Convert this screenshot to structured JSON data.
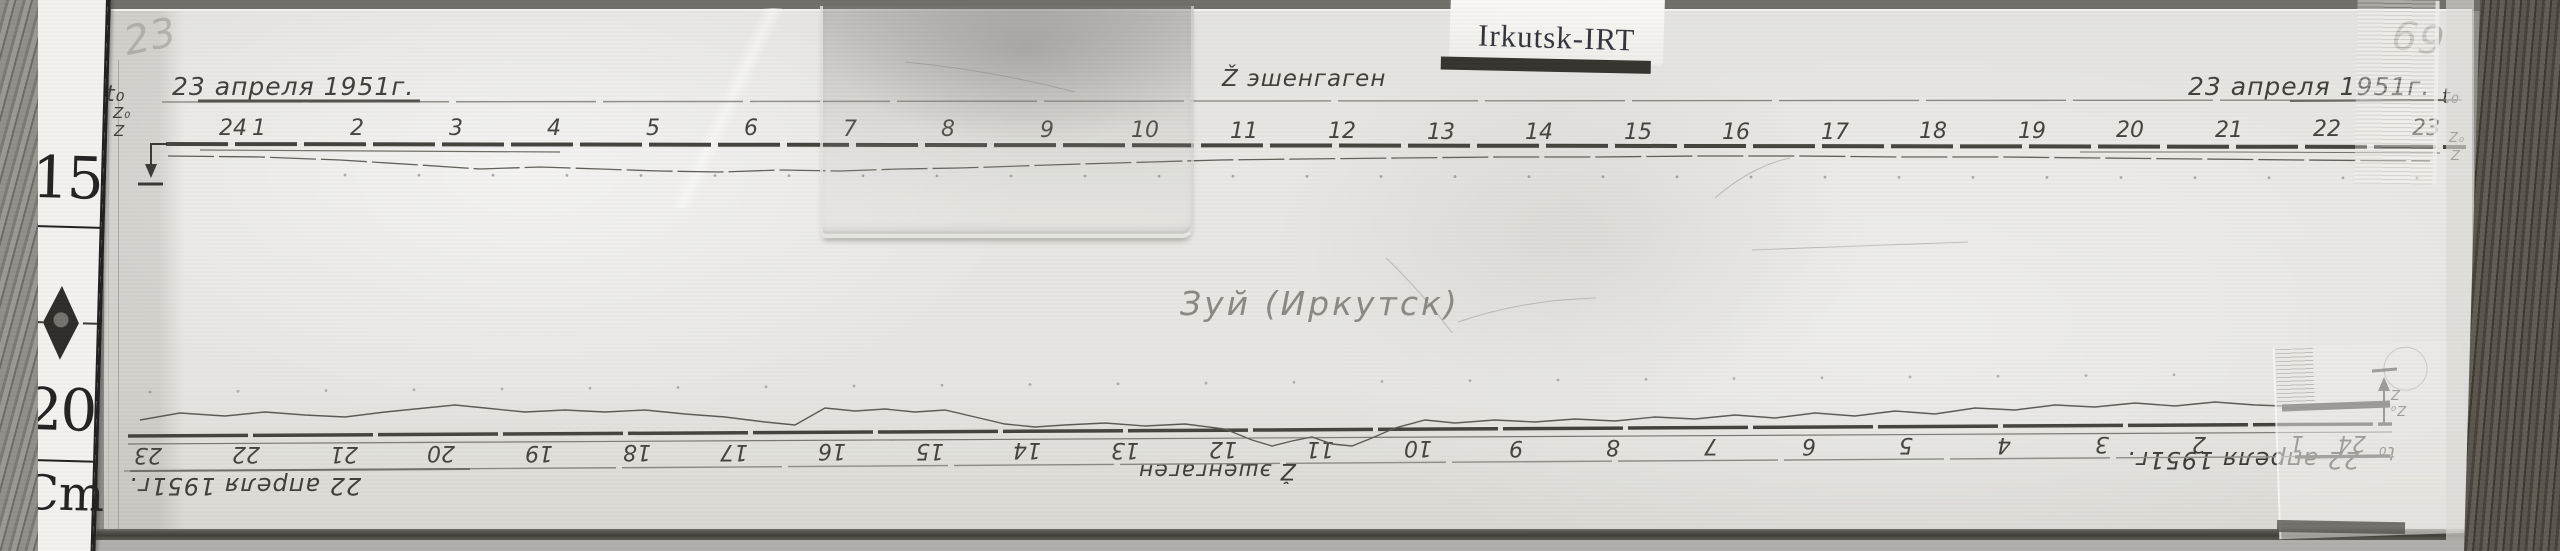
{
  "scene": {
    "tag_label": "Irkutsk-IRT",
    "corner_note_left": "23",
    "corner_note_right": "69",
    "center_note": "Зуй (Иркутск)"
  },
  "ruler": {
    "top_mark": "15",
    "bottom_mark": "20",
    "unit": "Cm"
  },
  "top_band": {
    "date_left": "23 апреля 1951г.",
    "date_right": "23 апреля 1951г.",
    "t0_left": "t₀",
    "t0_right": "t₀",
    "component": "Ž эшенгаген",
    "z0_left": "Z₀",
    "z_left": "Z",
    "z0_right": "Z₀",
    "z_right": "Z",
    "hours": [
      {
        "label": "24",
        "x": 233,
        "y": 116
      },
      {
        "label": "1",
        "x": 259,
        "y": 116
      },
      {
        "label": "2",
        "x": 357,
        "y": 116
      },
      {
        "label": "3",
        "x": 456,
        "y": 116
      },
      {
        "label": "4",
        "x": 554,
        "y": 116
      },
      {
        "label": "5",
        "x": 653,
        "y": 116
      },
      {
        "label": "6",
        "x": 751,
        "y": 116
      },
      {
        "label": "7",
        "x": 850,
        "y": 117
      },
      {
        "label": "8",
        "x": 948,
        "y": 117
      },
      {
        "label": "9",
        "x": 1047,
        "y": 118
      },
      {
        "label": "10",
        "x": 1145,
        "y": 118
      },
      {
        "label": "11",
        "x": 1244,
        "y": 119
      },
      {
        "label": "12",
        "x": 1342,
        "y": 119
      },
      {
        "label": "13",
        "x": 1441,
        "y": 120
      },
      {
        "label": "14",
        "x": 1539,
        "y": 120
      },
      {
        "label": "15",
        "x": 1638,
        "y": 120
      },
      {
        "label": "16",
        "x": 1736,
        "y": 120
      },
      {
        "label": "17",
        "x": 1835,
        "y": 120
      },
      {
        "label": "18",
        "x": 1933,
        "y": 119
      },
      {
        "label": "19",
        "x": 2032,
        "y": 119
      },
      {
        "label": "20",
        "x": 2130,
        "y": 118
      },
      {
        "label": "21",
        "x": 2229,
        "y": 118
      },
      {
        "label": "22",
        "x": 2327,
        "y": 117
      },
      {
        "label": "23",
        "x": 2426,
        "y": 116
      }
    ]
  },
  "bottom_band": {
    "date_left": "22 апреля 1951г.",
    "date_right": "22 апреля 1951г.",
    "t0_right": "t₀",
    "component": "Ž эшенгаген",
    "z": "Z",
    "z0": "Z₀",
    "hours": [
      {
        "label": "23",
        "x": 148,
        "y": 442
      },
      {
        "label": "22",
        "x": 246,
        "y": 441
      },
      {
        "label": "21",
        "x": 344,
        "y": 441
      },
      {
        "label": "20",
        "x": 441,
        "y": 440
      },
      {
        "label": "19",
        "x": 539,
        "y": 440
      },
      {
        "label": "18",
        "x": 637,
        "y": 439
      },
      {
        "label": "17",
        "x": 734,
        "y": 439
      },
      {
        "label": "16",
        "x": 832,
        "y": 438
      },
      {
        "label": "15",
        "x": 930,
        "y": 438
      },
      {
        "label": "14",
        "x": 1027,
        "y": 437
      },
      {
        "label": "13",
        "x": 1125,
        "y": 437
      },
      {
        "label": "12",
        "x": 1223,
        "y": 436
      },
      {
        "label": "11",
        "x": 1320,
        "y": 436
      },
      {
        "label": "10",
        "x": 1418,
        "y": 435
      },
      {
        "label": "9",
        "x": 1516,
        "y": 435
      },
      {
        "label": "8",
        "x": 1613,
        "y": 434
      },
      {
        "label": "7",
        "x": 1711,
        "y": 433
      },
      {
        "label": "6",
        "x": 1809,
        "y": 433
      },
      {
        "label": "5",
        "x": 1906,
        "y": 432
      },
      {
        "label": "4",
        "x": 2004,
        "y": 432
      },
      {
        "label": "3",
        "x": 2102,
        "y": 431
      },
      {
        "label": "2",
        "x": 2199,
        "y": 431
      },
      {
        "label": "1",
        "x": 2297,
        "y": 430
      },
      {
        "label": "24",
        "x": 2352,
        "y": 430
      }
    ]
  },
  "figure": {
    "ink": "#45433e",
    "top": {
      "t0_line": {
        "x1": 162,
        "y1": 102,
        "x2": 2462,
        "y2": 100,
        "w": 1.4,
        "color": "#8d8b85",
        "dash": "140 7",
        "overdraws": [
          {
            "x1": 198,
            "y1": 101,
            "x2": 420,
            "y2": 101,
            "w": 3,
            "color": "#55534e"
          },
          {
            "x1": 2290,
            "y1": 101,
            "x2": 2458,
            "y2": 100,
            "w": 2,
            "color": "#6b6964"
          }
        ]
      },
      "hour_line": {
        "x1": 166,
        "y1": 144,
        "x2": 2466,
        "y2": 147,
        "w": 4,
        "color": "#45433e",
        "dash": "62 7"
      },
      "lead": {
        "pts": [
          [
            200,
            150
          ],
          [
            380,
            151
          ],
          [
            560,
            152
          ]
        ],
        "w": 1.2,
        "color": "#716f68"
      },
      "main": {
        "pts": [
          [
            168,
            156
          ],
          [
            260,
            157
          ],
          [
            340,
            160
          ],
          [
            420,
            165
          ],
          [
            480,
            169
          ],
          [
            540,
            167
          ],
          [
            600,
            169
          ],
          [
            660,
            171
          ],
          [
            720,
            172
          ],
          [
            780,
            170
          ],
          [
            840,
            171
          ],
          [
            900,
            169
          ],
          [
            960,
            168
          ],
          [
            1020,
            166
          ],
          [
            1080,
            164
          ],
          [
            1150,
            162
          ],
          [
            1220,
            160
          ],
          [
            1300,
            159
          ],
          [
            1400,
            158
          ],
          [
            1500,
            157
          ],
          [
            1600,
            157
          ],
          [
            1700,
            156
          ],
          [
            1800,
            156
          ],
          [
            1900,
            157
          ],
          [
            2000,
            157
          ],
          [
            2100,
            158
          ],
          [
            2200,
            159
          ],
          [
            2300,
            160
          ],
          [
            2430,
            161
          ]
        ],
        "w": 1.3,
        "color": "#63615a",
        "dash": "46 5"
      },
      "right_extra": {
        "pts": [
          [
            2080,
            152
          ],
          [
            2230,
            152
          ],
          [
            2440,
            153
          ]
        ],
        "w": 1,
        "color": "#76746d"
      },
      "dots": {
        "x1": 345,
        "y1": 175,
        "x2": 2445,
        "y2": 178,
        "step": 74,
        "r": 1.4,
        "color": "rgba(70,68,62,0.4)"
      }
    },
    "bottom": {
      "hour_line": {
        "x1": 128,
        "y1": 436,
        "x2": 2392,
        "y2": 424,
        "w": 3.5,
        "color": "#45433e",
        "dash": "120 5"
      },
      "companion": {
        "x1": 128,
        "y1": 444,
        "x2": 2392,
        "y2": 432,
        "w": 1.2,
        "color": "#7b7973"
      },
      "t0_line": {
        "x1": 124,
        "y1": 471,
        "x2": 2392,
        "y2": 456,
        "w": 1.4,
        "color": "#8d8b85",
        "dash": "160 6",
        "overdraws": [
          {
            "x1": 2295,
            "y1": 457,
            "x2": 2390,
            "y2": 456,
            "w": 3.5,
            "color": "#4e4c47"
          },
          {
            "x1": 130,
            "y1": 471,
            "x2": 470,
            "y2": 469,
            "w": 2,
            "color": "#6f6d67"
          }
        ]
      },
      "main": {
        "pts": [
          [
            140,
            420
          ],
          [
            180,
            413
          ],
          [
            225,
            416
          ],
          [
            265,
            412
          ],
          [
            305,
            415
          ],
          [
            345,
            417
          ],
          [
            385,
            412
          ],
          [
            425,
            408
          ],
          [
            455,
            405
          ],
          [
            485,
            408
          ],
          [
            525,
            412
          ],
          [
            565,
            410
          ],
          [
            605,
            412
          ],
          [
            645,
            410
          ],
          [
            685,
            414
          ],
          [
            725,
            417
          ],
          [
            765,
            422
          ],
          [
            795,
            425
          ],
          [
            825,
            408
          ],
          [
            855,
            411
          ],
          [
            885,
            409
          ],
          [
            915,
            412
          ],
          [
            945,
            410
          ],
          [
            975,
            417
          ],
          [
            1005,
            424
          ],
          [
            1035,
            427
          ],
          [
            1065,
            425
          ],
          [
            1105,
            423
          ],
          [
            1145,
            426
          ],
          [
            1185,
            424
          ],
          [
            1225,
            429
          ],
          [
            1252,
            440
          ],
          [
            1272,
            446
          ],
          [
            1292,
            441
          ],
          [
            1312,
            437
          ],
          [
            1332,
            444
          ],
          [
            1352,
            446
          ],
          [
            1372,
            438
          ],
          [
            1395,
            428
          ],
          [
            1425,
            420
          ],
          [
            1455,
            423
          ],
          [
            1495,
            420
          ],
          [
            1535,
            422
          ],
          [
            1575,
            419
          ],
          [
            1615,
            421
          ],
          [
            1655,
            417
          ],
          [
            1695,
            419
          ],
          [
            1735,
            415
          ],
          [
            1775,
            418
          ],
          [
            1815,
            413
          ],
          [
            1855,
            416
          ],
          [
            1895,
            411
          ],
          [
            1935,
            414
          ],
          [
            1975,
            408
          ],
          [
            2015,
            410
          ],
          [
            2055,
            405
          ],
          [
            2095,
            407
          ],
          [
            2135,
            403
          ],
          [
            2175,
            406
          ],
          [
            2215,
            402
          ],
          [
            2255,
            405
          ],
          [
            2282,
            406
          ]
        ],
        "w": 1.4,
        "color": "#5d5b55"
      },
      "end_bar": {
        "pts": [
          [
            2282,
            408
          ],
          [
            2390,
            404
          ]
        ],
        "w": 7,
        "color": "#3a3833"
      },
      "dots": {
        "x1": 150,
        "y1": 392,
        "x2": 2260,
        "y2": 374,
        "step": 88,
        "r": 1.4,
        "color": "rgba(70,68,62,0.35)"
      }
    },
    "scratches": [
      "M905,62 Q990,70 1075,92",
      "M1715,198 Q1752,166 1790,158",
      "M1752,250 L1968,242",
      "M1458,322 Q1522,300 1596,298",
      "M1386,258 Q1422,292 1452,333"
    ],
    "scratch_color": "rgba(110,108,102,0.35)"
  }
}
